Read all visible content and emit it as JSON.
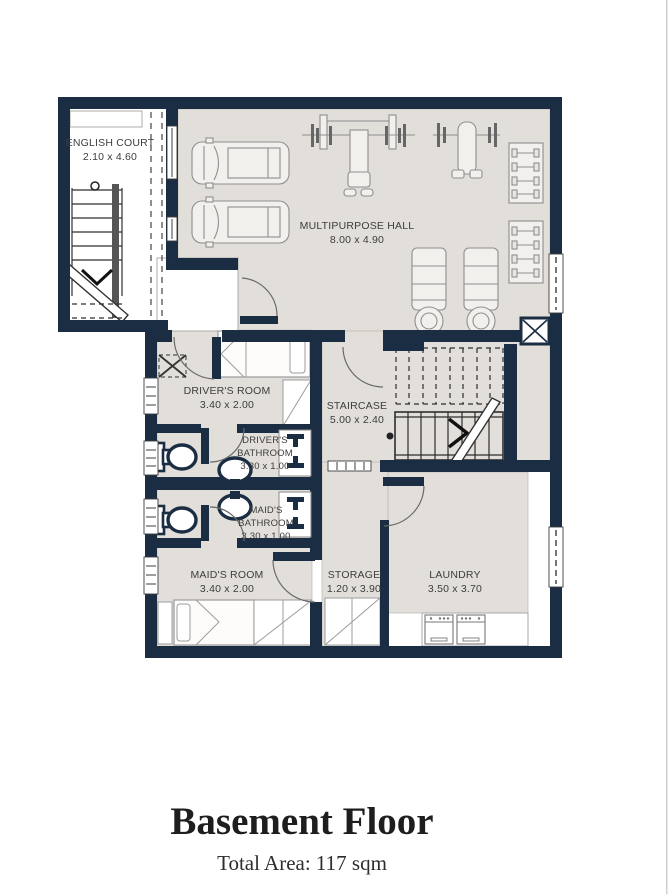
{
  "plan": {
    "english_court": {
      "label": "ENGLISH COURT",
      "dims": "2.10 x 4.60"
    },
    "multipurpose_hall": {
      "label": "MULTIPURPOSE HALL",
      "dims": "8.00 x 4.90"
    },
    "drivers_room": {
      "label": "DRIVER'S ROOM",
      "dims": "3.40 x 2.00"
    },
    "staircase": {
      "label": "STAIRCASE",
      "dims": "5.00 x 2.40"
    },
    "drivers_bathroom": {
      "label_line1": "DRIVER'S",
      "label_line2": "BATHROOM",
      "dims": "3.30 x 1.00"
    },
    "maids_bathroom": {
      "label_line1": "MAID'S",
      "label_line2": "BATHROOM",
      "dims": "3.30 x 1.00"
    },
    "maids_room": {
      "label": "MAID'S ROOM",
      "dims": "3.40 x 2.00"
    },
    "storage": {
      "label": "STORAGE",
      "dims": "1.20 x 3.90"
    },
    "laundry": {
      "label": "LAUNDRY",
      "dims": "3.50 x 3.70"
    }
  },
  "footer": {
    "title": "Basement Floor",
    "subtitle": "Total Area: 117 sqm"
  },
  "colors": {
    "wall": "#1b2d42",
    "floor": "#e2deda",
    "background": "#ffffff"
  }
}
